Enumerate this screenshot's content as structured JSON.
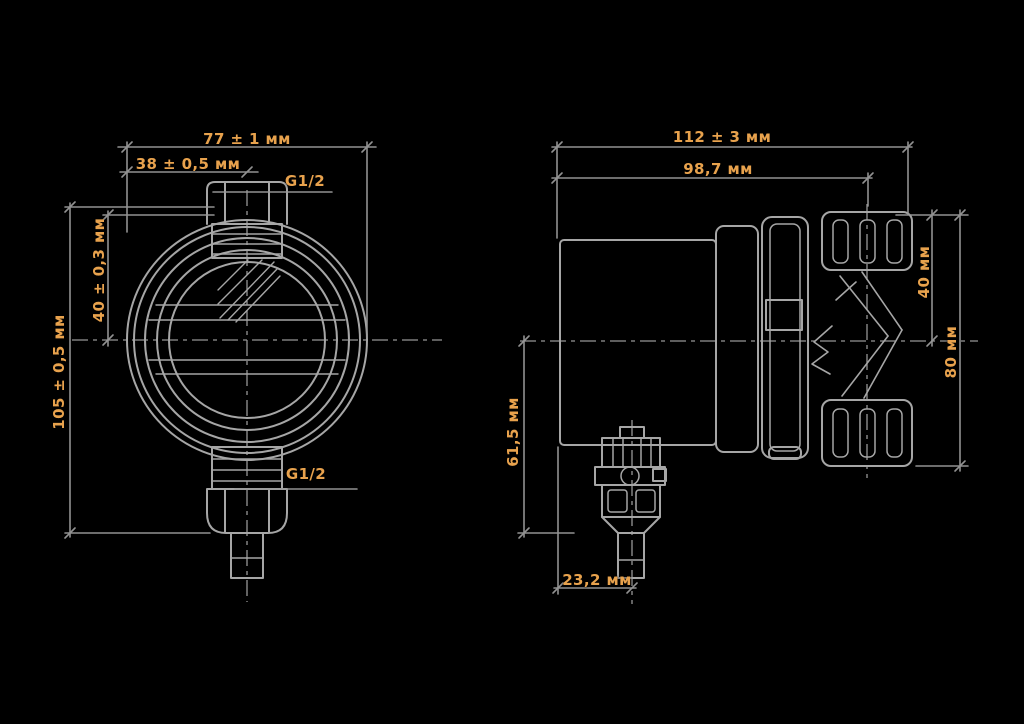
{
  "drawing": {
    "title": "pressure-gauge two-view dimensional drawing",
    "colors": {
      "background": "#000000",
      "linework": "#a6a6a6",
      "dimension_lines": "#999999",
      "dimension_text": "#e8a24d"
    },
    "front_view": {
      "labels": {
        "width_overall": "77 ± 1 мм",
        "width_half": "38 ± 0,5 мм",
        "thread_top": "G1/2",
        "height_overall": "105 ± 0,5 мм",
        "height_top": "40 ± 0,3 мм",
        "thread_bottom": "G1/2"
      }
    },
    "side_view": {
      "labels": {
        "depth_overall": "112 ± 3 мм",
        "depth_body": "98,7 мм",
        "fitting_top_height": "40 мм",
        "fitting_height": "80 мм",
        "bottom_drop_height": "61,5 мм",
        "bottom_axis_offset": "23,2 мм"
      }
    }
  }
}
